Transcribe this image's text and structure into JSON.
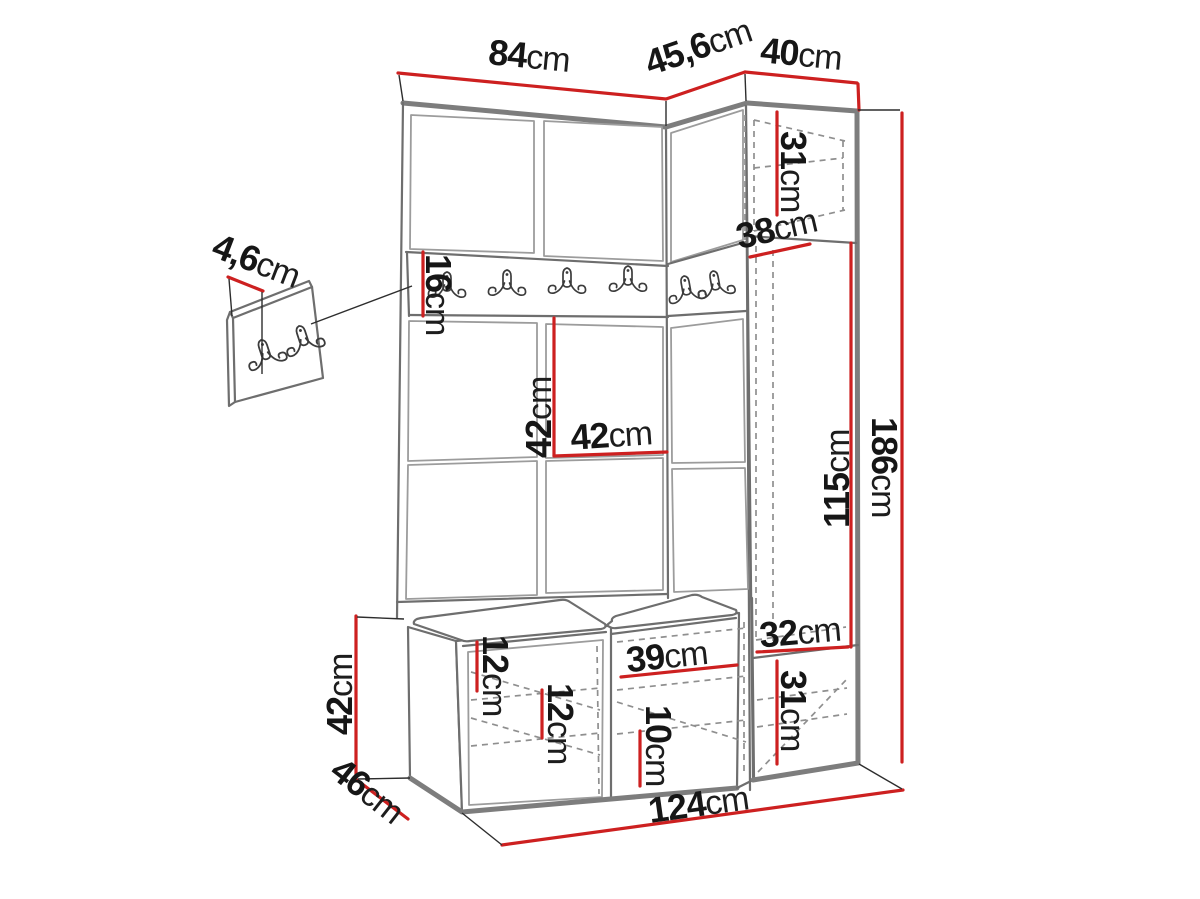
{
  "diagram": {
    "type": "furniture-dimension-drawing",
    "subject": "hallway wardrobe set with hook rail, bench and corner cabinet",
    "colors": {
      "dimension_line": "#cd2020",
      "outline": "#6e6e6e",
      "label_text": "#161616",
      "background": "#ffffff"
    },
    "hardware": {
      "rail_double_hooks": 6,
      "wall_panel_double_hooks": 2
    }
  },
  "dims": {
    "top_main_width": {
      "value": "84",
      "unit": "cm"
    },
    "top_corner_width": {
      "value": "45,6",
      "unit": "cm"
    },
    "top_right_width": {
      "value": "40",
      "unit": "cm"
    },
    "right_top_cab_height": {
      "value": "31",
      "unit": "cm"
    },
    "right_top_cab_depth": {
      "value": "38",
      "unit": "cm"
    },
    "rail_height": {
      "value": "16",
      "unit": "cm"
    },
    "hook_panel_thickness": {
      "value": "4,6",
      "unit": "cm"
    },
    "panel_height": {
      "value": "42",
      "unit": "cm"
    },
    "panel_width": {
      "value": "42",
      "unit": "cm"
    },
    "right_open_height": {
      "value": "115",
      "unit": "cm"
    },
    "total_height": {
      "value": "186",
      "unit": "cm"
    },
    "right_lower_width": {
      "value": "32",
      "unit": "cm"
    },
    "right_lower_height": {
      "value": "31",
      "unit": "cm"
    },
    "bench_height": {
      "value": "42",
      "unit": "cm"
    },
    "bench_depth": {
      "value": "46",
      "unit": "cm"
    },
    "shelf_gap_a": {
      "value": "12",
      "unit": "cm"
    },
    "shelf_gap_b": {
      "value": "12",
      "unit": "cm"
    },
    "mid_compartment_width": {
      "value": "39",
      "unit": "cm"
    },
    "mid_shelf_gap": {
      "value": "10",
      "unit": "cm"
    },
    "total_width": {
      "value": "124",
      "unit": "cm"
    }
  }
}
